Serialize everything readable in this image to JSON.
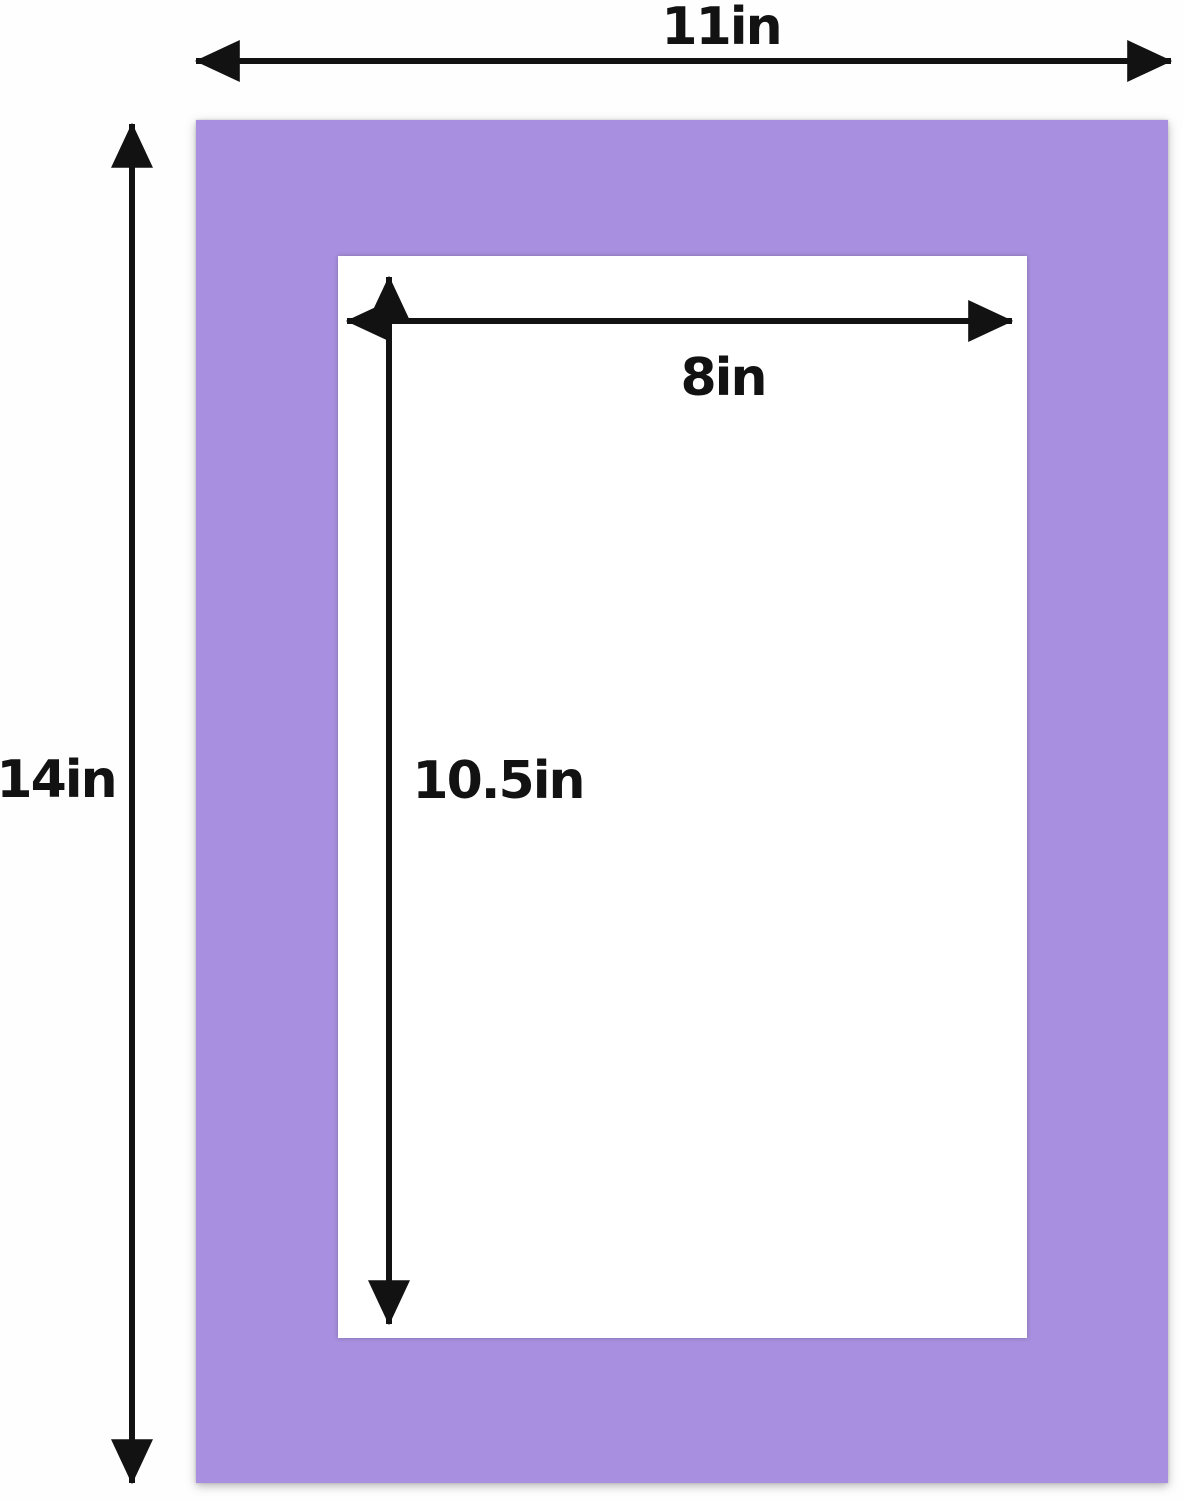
{
  "diagram": {
    "type": "picture-mat-dimension-diagram",
    "outer_width": {
      "label": "11in",
      "value": 11,
      "unit": "in"
    },
    "outer_height": {
      "label": "14in",
      "value": 14,
      "unit": "in"
    },
    "opening_width": {
      "label": "8in",
      "value": 8,
      "unit": "in"
    },
    "opening_height": {
      "label": "10.5in",
      "value": 10.5,
      "unit": "in"
    },
    "colors": {
      "mat": "#a88fe0",
      "opening": "#ffffff",
      "background": "#fefefe",
      "arrows": "#121212",
      "text": "#121212"
    }
  }
}
